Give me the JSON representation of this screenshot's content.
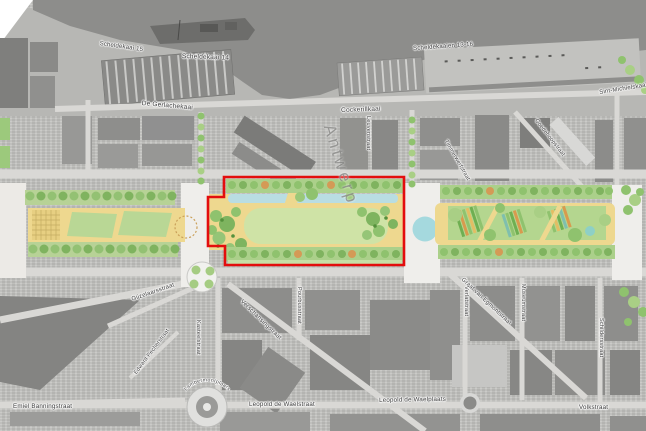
{
  "watermark": {
    "city": "Antwerp"
  },
  "street_labels": [
    {
      "id": "scheldekaai-15",
      "text": "Scheldekaai 15"
    },
    {
      "id": "scheldekaai-14",
      "text": "Scheldekaai 14"
    },
    {
      "id": "scheldekaaien-13-16",
      "text": "Scheldekaaien 13-16"
    },
    {
      "id": "de-gerlachekaai",
      "text": "De Gerlachekaai"
    },
    {
      "id": "cockerillkaai",
      "text": "Cockerillkaai"
    },
    {
      "id": "sint-michielskaai",
      "text": "Sint-Michielskaai"
    },
    {
      "id": "leuvenstraat",
      "text": "Leuvenstraat"
    },
    {
      "id": "timmerwerfstraat",
      "text": "Timmerwerfstraat"
    },
    {
      "id": "goedehoopstraat",
      "text": "Goedehoopstraat"
    },
    {
      "id": "gijzelaarsstraat",
      "text": "Gijzelaarsstraat"
    },
    {
      "id": "edward-pecherstraat",
      "text": "Edward Pecherstraat"
    },
    {
      "id": "kasteelstraat",
      "text": "Kasteelstraat"
    },
    {
      "id": "verschansingstraat",
      "text": "Verschansingstraat"
    },
    {
      "id": "pourbusstraat",
      "text": "Pourbusstraat"
    },
    {
      "id": "lambermontplaats",
      "text": "Lambermontplaats"
    },
    {
      "id": "leopold-de-waelstraat",
      "text": "Leopold de Waelstraat"
    },
    {
      "id": "emiel-banningstraat",
      "text": "Emiel Banningstraat"
    },
    {
      "id": "leopold-de-waelplaats",
      "text": "Leopold de Waelplaats"
    },
    {
      "id": "volkstraat",
      "text": "Volkstraat"
    },
    {
      "id": "graaf-van-egmontstraat",
      "text": "Graaf van Egmontstraat"
    },
    {
      "id": "verlatstraat",
      "text": "Verlatstraat"
    },
    {
      "id": "museumstraat",
      "text": "Museumstraat"
    },
    {
      "id": "schildersstraat",
      "text": "Schildersstraat"
    }
  ],
  "colors": {
    "highlight_red": "#e30d0d",
    "park_tree_green": "#8fc26e",
    "park_band_green": "#abd08a",
    "lawn_green": "#cfe3a6",
    "sand_yellow": "#eed88f",
    "water_channel_blue": "#b9dde2",
    "pond_blue": "#a5d9de",
    "river_gray": "#8d8d8b"
  }
}
